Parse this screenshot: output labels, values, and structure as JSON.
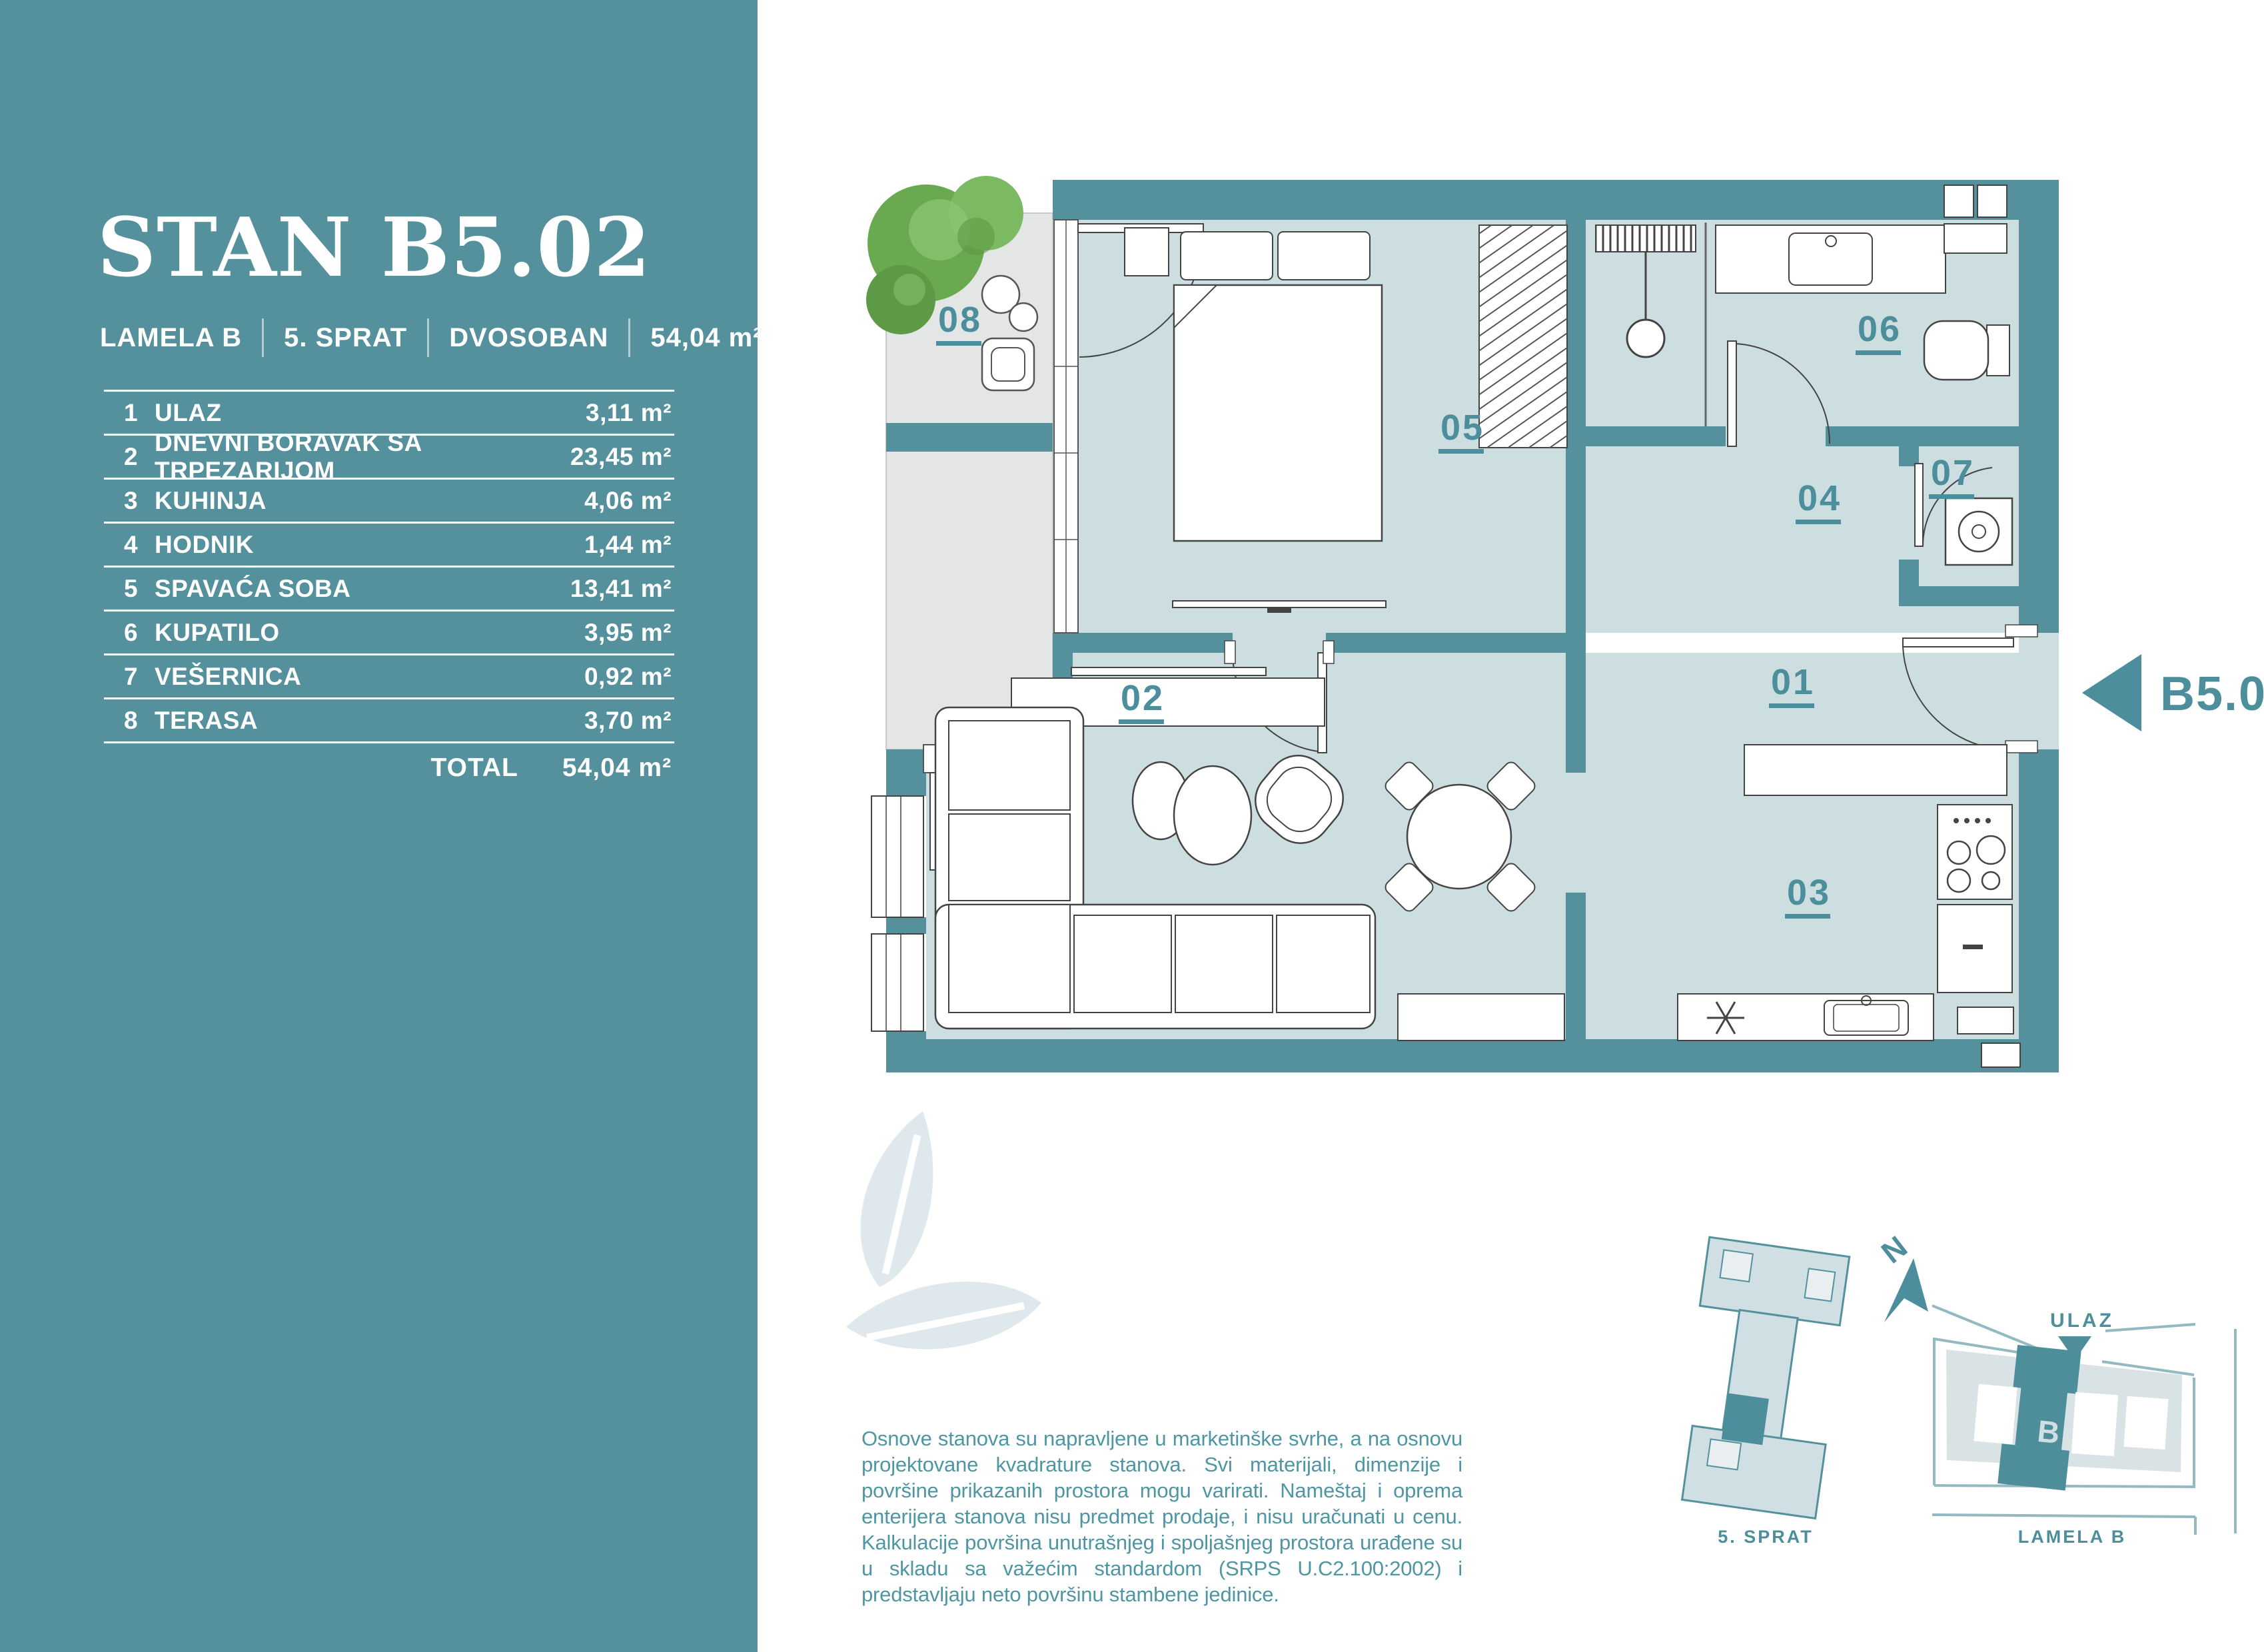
{
  "sidebar": {
    "title": "STAN B5.02",
    "meta": [
      {
        "label": "LAMELA B"
      },
      {
        "label": "5. SPRAT"
      },
      {
        "label": "DVOSOBAN"
      },
      {
        "label": "54,04 m²"
      }
    ],
    "table": {
      "rows": [
        {
          "num": "1",
          "name": "ULAZ",
          "area": "3,11 m²"
        },
        {
          "num": "2",
          "name": "DNEVNI BORAVAK SA TRPEZARIJOM",
          "area": "23,45 m²"
        },
        {
          "num": "3",
          "name": "KUHINJA",
          "area": "4,06 m²"
        },
        {
          "num": "4",
          "name": "HODNIK",
          "area": "1,44 m²"
        },
        {
          "num": "5",
          "name": "SPAVAĆA SOBA",
          "area": "13,41 m²"
        },
        {
          "num": "6",
          "name": "KUPATILO",
          "area": "3,95 m²"
        },
        {
          "num": "7",
          "name": "VEŠERNICA",
          "area": "0,92 m²"
        },
        {
          "num": "8",
          "name": "TERASA",
          "area": "3,70 m²"
        }
      ],
      "total_label": "TOTAL",
      "total_area": "54,04 m²"
    }
  },
  "plan": {
    "unit_label": "B5.02",
    "compass": "N",
    "rooms": {
      "r01": "01",
      "r02": "02",
      "r03": "03",
      "r04": "04",
      "r05": "05",
      "r06": "06",
      "r07": "07",
      "r08": "08"
    }
  },
  "minimap": {
    "floor_caption": "5. SPRAT",
    "site_caption": "LAMELA B",
    "entrance_label": "ULAZ",
    "building_letter": "B"
  },
  "footer": {
    "disclaimer": "Osnove stanova su napravljene u marketinške svrhe, a na osnovu projektovane kvadrature stanova. Svi materijali, dimenzije i površine prikazanih prostora mogu varirati. Nameštaj i oprema enterijera stanova nisu predmet prodaje, i nisu uračunati u cenu. Kalkulacije površina unutrašnjeg i spoljašnjeg prostora urađene su u skladu sa važećim standardom (SRPS U.C2.100:2002) i predstavljaju neto površinu stambene jedinice."
  },
  "colors": {
    "sidebar_teal": "#55919c",
    "wall_teal": "#55919c",
    "room_fill": "#cddee1",
    "terrace_fill": "#e4e6e5",
    "accent_teal": "#4d8e9c",
    "watermark": "#dfe8ec",
    "tree_green": "#69a94f"
  }
}
